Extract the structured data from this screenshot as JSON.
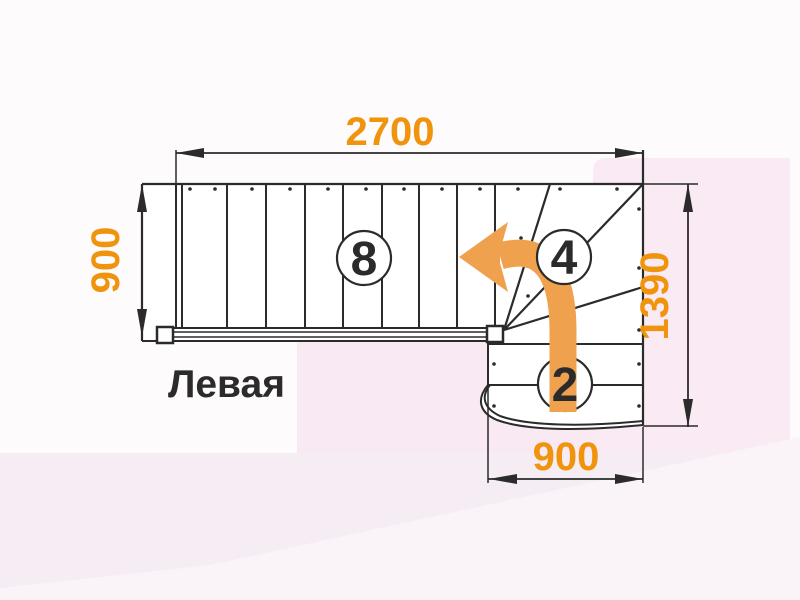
{
  "title": "Левая",
  "dimensions": {
    "top": "2700",
    "left": "900",
    "right": "1390",
    "bottom": "900"
  },
  "steps": {
    "main_flight": "8",
    "winder": "4",
    "lower_flight": "2"
  },
  "colors": {
    "dimension_text": "#F0930D",
    "arrow": "#EFA14E",
    "line": "#2B2B2B"
  }
}
